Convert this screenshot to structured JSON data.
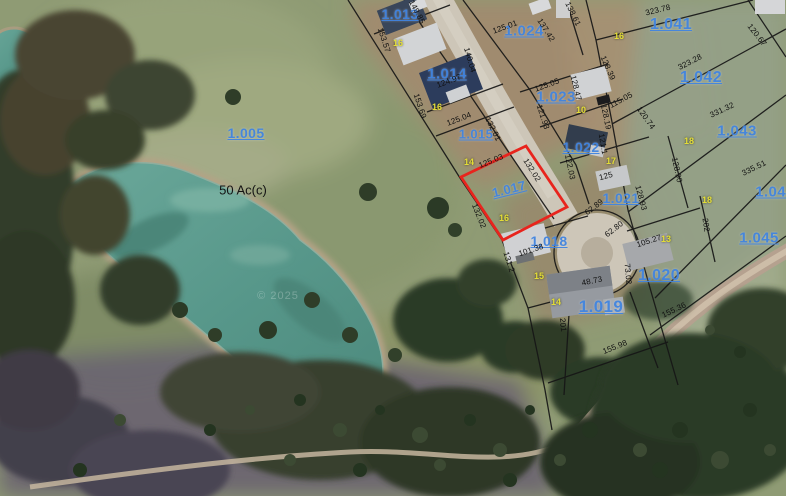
{
  "map": {
    "selected_parcel": {
      "id": "1.017",
      "outline_color": "#e8241d"
    },
    "annotations": {
      "area_label": {
        "text": "50 Ac(c)"
      },
      "watermark": {
        "text": "© 2025"
      }
    },
    "colors": {
      "parcel_label_blue": "#4285e0",
      "dimension_black": "#101010",
      "lot_number_yellow": "#e3dd36",
      "selection_red": "#e8241d",
      "road_gray": "#cdc6b8",
      "pond_teal": "#5c9a8c"
    },
    "parcel_labels": [
      {
        "id": "1.005",
        "x": 246,
        "y": 133,
        "size": 14
      },
      {
        "id": "1.013",
        "x": 400,
        "y": 14,
        "size": 14
      },
      {
        "id": "1.014",
        "x": 447,
        "y": 74,
        "size": 15
      },
      {
        "id": "1.015",
        "x": 476,
        "y": 134,
        "size": 13
      },
      {
        "id": "1.017",
        "x": 509,
        "y": 189,
        "size": 13,
        "r": -14
      },
      {
        "id": "1.018",
        "x": 549,
        "y": 241,
        "size": 14
      },
      {
        "id": "1.019",
        "x": 601,
        "y": 307,
        "size": 17
      },
      {
        "id": "1.020",
        "x": 659,
        "y": 276,
        "size": 16
      },
      {
        "id": "1.021",
        "x": 621,
        "y": 198,
        "size": 14
      },
      {
        "id": "1.022",
        "x": 581,
        "y": 147,
        "size": 14
      },
      {
        "id": "1.023",
        "x": 556,
        "y": 97,
        "size": 15
      },
      {
        "id": "1.024",
        "x": 524,
        "y": 31,
        "size": 15
      },
      {
        "id": "1.041",
        "x": 671,
        "y": 25,
        "size": 16
      },
      {
        "id": "1.042",
        "x": 701,
        "y": 78,
        "size": 16
      },
      {
        "id": "1.043",
        "x": 737,
        "y": 131,
        "size": 15
      },
      {
        "id": "1.044",
        "x": 775,
        "y": 192,
        "size": 15
      },
      {
        "id": "1.045",
        "x": 759,
        "y": 238,
        "size": 15
      }
    ],
    "dimension_labels": [
      {
        "t": "149.85",
        "x": 417,
        "y": 12,
        "r": 62
      },
      {
        "t": "153.57",
        "x": 384,
        "y": 40,
        "r": 72
      },
      {
        "t": "124.97",
        "x": 449,
        "y": 81,
        "r": -21
      },
      {
        "t": "153.69",
        "x": 420,
        "y": 106,
        "r": 72
      },
      {
        "t": "125.04",
        "x": 459,
        "y": 119,
        "r": -21
      },
      {
        "t": "132.01",
        "x": 493,
        "y": 129,
        "r": 64
      },
      {
        "t": "125.03",
        "x": 491,
        "y": 161,
        "r": -22
      },
      {
        "t": "132.02",
        "x": 532,
        "y": 170,
        "r": 58
      },
      {
        "t": "132.02",
        "x": 479,
        "y": 216,
        "r": 68
      },
      {
        "t": "125.01",
        "x": 505,
        "y": 27,
        "r": -20
      },
      {
        "t": "137.42",
        "x": 546,
        "y": 30,
        "r": 58
      },
      {
        "t": "140.04",
        "x": 470,
        "y": 60,
        "r": 74
      },
      {
        "t": "138.61",
        "x": 573,
        "y": 14,
        "r": 64
      },
      {
        "t": "125.05",
        "x": 547,
        "y": 85,
        "r": -20
      },
      {
        "t": "121.93",
        "x": 543,
        "y": 117,
        "r": 72
      },
      {
        "t": "128.47",
        "x": 576,
        "y": 88,
        "r": 76
      },
      {
        "t": "128.39",
        "x": 608,
        "y": 68,
        "r": 66
      },
      {
        "t": "115.05",
        "x": 621,
        "y": 100,
        "r": -28
      },
      {
        "t": "128.19",
        "x": 606,
        "y": 117,
        "r": 78
      },
      {
        "t": "121.1",
        "x": 603,
        "y": 144,
        "r": 80
      },
      {
        "t": "120.74",
        "x": 646,
        "y": 118,
        "r": 55
      },
      {
        "t": "122.03",
        "x": 570,
        "y": 167,
        "r": 78
      },
      {
        "t": "125",
        "x": 606,
        "y": 176,
        "r": -15
      },
      {
        "t": "128.90",
        "x": 677,
        "y": 170,
        "r": 78
      },
      {
        "t": "128.93",
        "x": 641,
        "y": 198,
        "r": 75
      },
      {
        "t": "62.89",
        "x": 594,
        "y": 207,
        "r": -38
      },
      {
        "t": "62.80",
        "x": 614,
        "y": 229,
        "r": -38
      },
      {
        "t": "105.27",
        "x": 649,
        "y": 241,
        "r": -18
      },
      {
        "t": "202",
        "x": 706,
        "y": 225,
        "r": 82
      },
      {
        "t": "73.02",
        "x": 628,
        "y": 274,
        "r": 85
      },
      {
        "t": "48.73",
        "x": 592,
        "y": 281,
        "r": -12
      },
      {
        "t": "155.36",
        "x": 674,
        "y": 310,
        "r": -25
      },
      {
        "t": "155.98",
        "x": 615,
        "y": 347,
        "r": -22
      },
      {
        "t": "201",
        "x": 563,
        "y": 325,
        "r": 85
      },
      {
        "t": "101.38",
        "x": 531,
        "y": 250,
        "r": -18
      },
      {
        "t": "131.2",
        "x": 509,
        "y": 262,
        "r": 72
      },
      {
        "t": "323.78",
        "x": 658,
        "y": 10,
        "r": -14
      },
      {
        "t": "323.28",
        "x": 690,
        "y": 62,
        "r": -27
      },
      {
        "t": "120.67",
        "x": 757,
        "y": 35,
        "r": 52
      },
      {
        "t": "331.32",
        "x": 722,
        "y": 110,
        "r": -25
      },
      {
        "t": "335.51",
        "x": 754,
        "y": 168,
        "r": -26
      }
    ],
    "lot_numbers": [
      {
        "t": "16",
        "x": 398,
        "y": 43
      },
      {
        "t": "16",
        "x": 437,
        "y": 107
      },
      {
        "t": "14",
        "x": 469,
        "y": 162
      },
      {
        "t": "16",
        "x": 504,
        "y": 218
      },
      {
        "t": "10",
        "x": 581,
        "y": 110
      },
      {
        "t": "17",
        "x": 611,
        "y": 161
      },
      {
        "t": "16",
        "x": 619,
        "y": 36
      },
      {
        "t": "18",
        "x": 689,
        "y": 141
      },
      {
        "t": "18",
        "x": 707,
        "y": 200
      },
      {
        "t": "13",
        "x": 666,
        "y": 239
      },
      {
        "t": "15",
        "x": 539,
        "y": 276
      },
      {
        "t": "14",
        "x": 556,
        "y": 302
      }
    ]
  }
}
